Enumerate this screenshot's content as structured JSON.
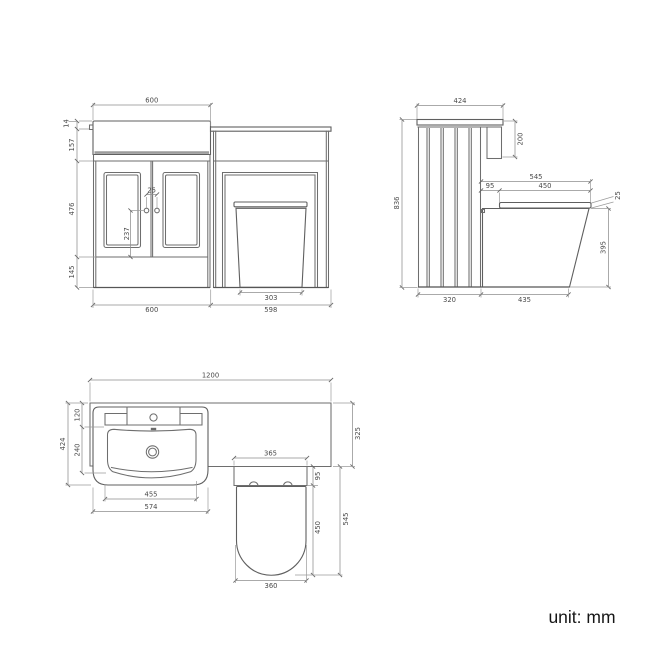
{
  "footer": {
    "unit_label": "unit: mm"
  },
  "front_view": {
    "dims": {
      "top_width": "600",
      "basin_overhang": "14",
      "upper_height": "157",
      "door_height": "476",
      "plinth_height": "145",
      "handle_spacing": "25",
      "handle_height": "237",
      "pan_base_width": "303",
      "vanity_width": "600",
      "wc_unit_width": "598"
    }
  },
  "side_view": {
    "dims": {
      "top_depth": "424",
      "basin_drop": "200",
      "total_height": "836",
      "seat_overall": "545",
      "seat_setback": "95",
      "seat_length": "450",
      "seat_thickness": "25",
      "pan_height": "395",
      "cabinet_depth": "320",
      "pan_projection": "435"
    }
  },
  "plan_view": {
    "dims": {
      "total_width": "1200",
      "basin_depth": "424",
      "back_ledge": "120",
      "bowl_depth": "240",
      "bowl_width": "455",
      "basin_width": "574",
      "pan_recess_width": "365",
      "seat_setback": "95",
      "seat_length": "450",
      "pan_projection": "545",
      "worktop_depth": "325",
      "pan_front_width": "360"
    }
  }
}
